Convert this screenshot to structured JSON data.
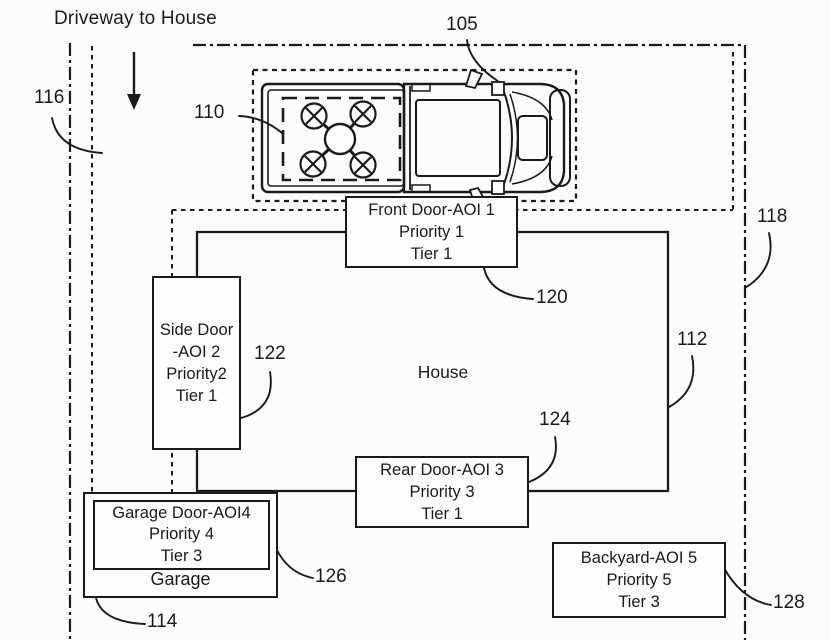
{
  "title": "Driveway to House",
  "labels": {
    "house": "House",
    "garage": "Garage"
  },
  "boxes": {
    "front_door": [
      "Front Door-AOI 1",
      "Priority 1",
      "Tier 1"
    ],
    "side_door": [
      "Side Door",
      "-AOI 2",
      "Priority2",
      "Tier 1"
    ],
    "rear_door": [
      "Rear  Door-AOI 3",
      "Priority 3",
      "Tier 1"
    ],
    "garage_door": [
      "Garage Door-AOI4",
      "Priority 4",
      "Tier 3"
    ],
    "backyard": [
      "Backyard-AOI 5",
      "Priority 5",
      "Tier 3"
    ]
  },
  "refs": {
    "r105": "105",
    "r110": "110",
    "r112": "112",
    "r114": "114",
    "r116": "116",
    "r118": "118",
    "r120": "120",
    "r122": "122",
    "r124": "124",
    "r126": "126",
    "r128": "128"
  },
  "icons": {
    "driveway_arrow": "down-arrow",
    "vehicle": "pickup-truck-top-view",
    "drone": "quadcopter-drone"
  },
  "colors": {
    "ink": "#1a1a1a",
    "background": "#fcfcfb"
  }
}
